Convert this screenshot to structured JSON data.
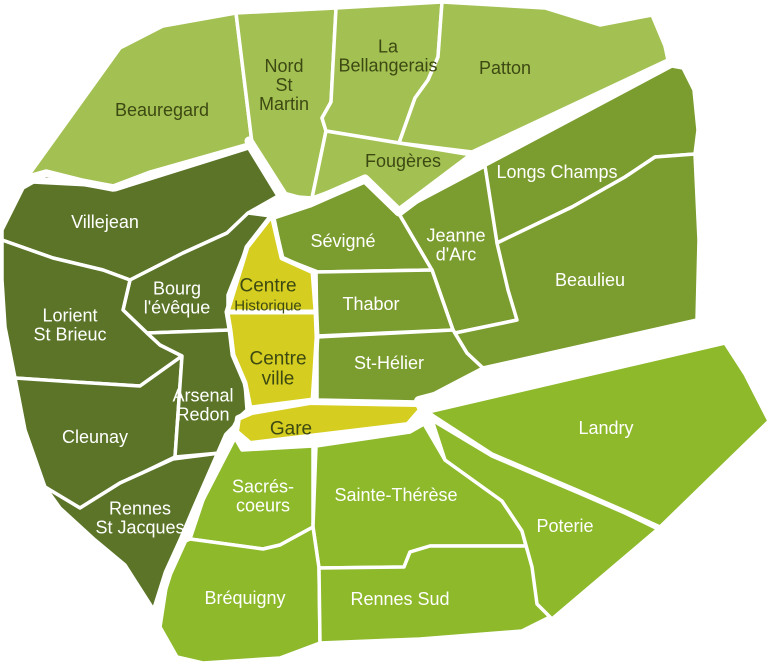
{
  "map": {
    "title": "Quartiers de Rennes",
    "background": "#ffffff",
    "width": 784,
    "height": 667
  },
  "colors": {
    "outer_north": "#a3c052",
    "inner_west": "#5b7428",
    "inner_east": "#7b9c2e",
    "outer_south": "#8db92a",
    "centre": "#d5cd1f",
    "border": "#ffffff",
    "label_dark": "#3d4912",
    "label_light": "#ffffff"
  },
  "districts": [
    {
      "id": "beauregard",
      "name": "Beauregard",
      "lines": [
        "Beauregard"
      ],
      "zone": "outer_north",
      "label": {
        "x": 162,
        "y": 110,
        "color": "dark",
        "size": 18
      },
      "points": "28,176 120,48 163,26 236,13 252,143 150,172 113,186 82,180 46,171"
    },
    {
      "id": "nord-st-martin",
      "name": "Nord St Martin",
      "lines": [
        "Nord",
        "St",
        "Martin"
      ],
      "zone": "outer_north",
      "label": {
        "x": 284,
        "y": 85,
        "color": "dark",
        "size": 18
      },
      "points": "236,13 336,8 331,102 322,118 326,131 312,198 283,196 252,143"
    },
    {
      "id": "la-bellangerais",
      "name": "La Bellangerais",
      "lines": [
        "La",
        "Bellangerais"
      ],
      "zone": "outer_north",
      "label": {
        "x": 388,
        "y": 56,
        "color": "dark",
        "size": 18
      },
      "points": "336,8 442,2 438,57 428,80 415,98 399,143 326,131 322,118 331,102"
    },
    {
      "id": "patton",
      "name": "Patton",
      "lines": [
        "Patton"
      ],
      "zone": "outer_north",
      "label": {
        "x": 505,
        "y": 68,
        "color": "dark",
        "size": 18
      },
      "points": "442,2 545,8 600,25 652,15 665,46 668,60 472,152 399,143 415,98 428,80 438,57"
    },
    {
      "id": "fougeres",
      "name": "Fougères",
      "lines": [
        "Fougères"
      ],
      "zone": "outer_north",
      "label": {
        "x": 403,
        "y": 161,
        "color": "dark",
        "size": 18
      },
      "points": "326,131 399,143 472,155 399,212 365,179 312,198"
    },
    {
      "id": "longs-champs",
      "name": "Longs Champs",
      "lines": [
        "Longs Champs"
      ],
      "zone": "inner_east",
      "label": {
        "x": 557,
        "y": 172,
        "color": "light",
        "size": 18
      },
      "points": "480,168 672,66 683,68 694,90 698,130 695,154 655,157 625,177 572,207 497,243"
    },
    {
      "id": "villejean",
      "name": "Villejean",
      "lines": [
        "Villejean"
      ],
      "zone": "inner_west",
      "label": {
        "x": 105,
        "y": 222,
        "color": "light",
        "size": 18
      },
      "points": "23,188 46,175 82,184 113,190 150,176 248,147 278,196 248,213 227,233 183,253 130,280 103,270 53,258 2,240 2,230"
    },
    {
      "id": "bourg-leveque",
      "name": "Bourg l'évêque",
      "lines": [
        "Bourg",
        "l'évêque"
      ],
      "zone": "inner_west",
      "label": {
        "x": 177,
        "y": 298,
        "color": "light",
        "size": 18
      },
      "points": "130,280 183,253 227,233 248,213 271,216 247,247 228,295 228,312 230,330 147,333 123,310"
    },
    {
      "id": "lorient-st-brieuc",
      "name": "Lorient St Brieuc",
      "lines": [
        "Lorient",
        "St Brieuc"
      ],
      "zone": "inner_west",
      "label": {
        "x": 70,
        "y": 325,
        "color": "light",
        "size": 18
      },
      "points": "2,240 53,258 103,270 130,280 123,310 147,333 160,345 182,356 140,386 75,382 15,378 5,327 2,280"
    },
    {
      "id": "cleunay",
      "name": "Cleunay",
      "lines": [
        "Cleunay"
      ],
      "zone": "inner_west",
      "label": {
        "x": 95,
        "y": 437,
        "color": "light",
        "size": 18
      },
      "points": "15,378 75,382 140,386 182,356 175,457 140,474 120,483 80,508 45,487 25,430"
    },
    {
      "id": "arsenal-redon",
      "name": "Arsenal Redon",
      "lines": [
        "Arsenal",
        "Redon"
      ],
      "zone": "inner_west",
      "label": {
        "x": 203,
        "y": 405,
        "color": "light",
        "size": 18
      },
      "points": "147,333 230,330 233,355 245,383 247,410 238,418 220,453 175,457 182,356 160,345"
    },
    {
      "id": "rennes-st-jacques",
      "name": "Rennes St Jacques",
      "lines": [
        "Rennes",
        "St Jacques"
      ],
      "zone": "inner_west",
      "label": {
        "x": 140,
        "y": 518,
        "color": "light",
        "size": 18
      },
      "points": "45,487 80,508 120,483 173,459 220,453 197,507 183,540 168,573 155,612 125,565 95,540 60,508"
    },
    {
      "id": "sevigne",
      "name": "Sévigné",
      "lines": [
        "Sévigné"
      ],
      "zone": "inner_east",
      "label": {
        "x": 343,
        "y": 241,
        "color": "light",
        "size": 18
      },
      "points": "274,218 310,206 365,181 398,212 432,270 318,272 282,258"
    },
    {
      "id": "jeanne-darc",
      "name": "Jeanne d'Arc",
      "lines": [
        "Jeanne",
        "d'Arc"
      ],
      "zone": "inner_east",
      "label": {
        "x": 456,
        "y": 245,
        "color": "light",
        "size": 18
      },
      "points": "398,212 485,166 497,243 517,320 503,323 455,333 453,330 432,270"
    },
    {
      "id": "thabor",
      "name": "Thabor",
      "lines": [
        "Thabor"
      ],
      "zone": "inner_east",
      "label": {
        "x": 371,
        "y": 304,
        "color": "light",
        "size": 18
      },
      "points": "316,272 432,270 453,330 317,336"
    },
    {
      "id": "st-helier",
      "name": "St-Hélier",
      "lines": [
        "St-Hélier"
      ],
      "zone": "inner_east",
      "label": {
        "x": 389,
        "y": 363,
        "color": "light",
        "size": 18
      },
      "points": "317,337 453,330 467,353 483,368 418,402 317,400"
    },
    {
      "id": "beaulieu",
      "name": "Beaulieu",
      "lines": [
        "Beaulieu"
      ],
      "zone": "inner_east",
      "label": {
        "x": 590,
        "y": 280,
        "color": "light",
        "size": 18
      },
      "points": "497,243 572,207 625,177 655,157 695,154 699,240 697,320 483,368 467,353 455,333 503,323 517,320 508,290"
    },
    {
      "id": "centre-historique",
      "name": "Centre Historique",
      "lines": [
        "Centre",
        "Historique"
      ],
      "zone": "centre",
      "label": {
        "x": 268,
        "y": 296,
        "color": "dark",
        "size": 19,
        "line_sizes": [
          19,
          15
        ]
      },
      "points": "272,215 282,258 313,272 316,312 227,312 247,247"
    },
    {
      "id": "centre-ville",
      "name": "Centre ville",
      "lines": [
        "Centre",
        "ville"
      ],
      "zone": "centre",
      "label": {
        "x": 278,
        "y": 369,
        "color": "dark",
        "size": 19
      },
      "points": "227,312 316,312 317,337 315,370 313,400 250,408 245,383 233,355 230,330"
    },
    {
      "id": "sacres-coeurs",
      "name": "Sacrés-coeurs",
      "lines": [
        "Sacrés-",
        "coeurs"
      ],
      "zone": "outer_south",
      "label": {
        "x": 263,
        "y": 496,
        "color": "light",
        "size": 18
      },
      "points": "242,450 313,446 313,527 280,545 263,549 190,539 203,500 235,438"
    },
    {
      "id": "sainte-therese",
      "name": "Sainte-Thérèse",
      "lines": [
        "Sainte-Thérèse"
      ],
      "zone": "outer_south",
      "label": {
        "x": 396,
        "y": 495,
        "color": "light",
        "size": 18
      },
      "points": "316,446 410,432 424,424 445,460 502,501 522,531 526,546 430,546 410,552 404,567 319,568 313,527"
    },
    {
      "id": "brequigny",
      "name": "Bréquigny",
      "lines": [
        "Bréquigny"
      ],
      "zone": "outer_south",
      "label": {
        "x": 245,
        "y": 598,
        "color": "light",
        "size": 18
      },
      "points": "190,539 263,549 280,545 313,527 319,568 320,643 280,658 203,663 177,657 160,627 168,575 183,542"
    },
    {
      "id": "rennes-sud",
      "name": "Rennes Sud",
      "lines": [
        "Rennes Sud"
      ],
      "zone": "outer_south",
      "label": {
        "x": 400,
        "y": 599,
        "color": "light",
        "size": 18
      },
      "points": "319,568 404,567 410,552 430,546 526,546 550,617 522,631 420,639 320,643"
    },
    {
      "id": "landry",
      "name": "Landry",
      "lines": [
        "Landry"
      ],
      "zone": "outer_south",
      "label": {
        "x": 606,
        "y": 428,
        "color": "light",
        "size": 18
      },
      "points": "428,412 725,343 745,374 769,421 660,527 625,511 579,491 492,454 435,417"
    },
    {
      "id": "poterie",
      "name": "Poterie",
      "lines": [
        "Poterie"
      ],
      "zone": "outer_south",
      "label": {
        "x": 565,
        "y": 526,
        "color": "light",
        "size": 18
      },
      "points": "432,420 492,456 579,493 625,513 658,529 552,619 537,604 532,567 522,531 502,501 445,460"
    },
    {
      "id": "gare",
      "name": "Gare",
      "lines": [
        "Gare"
      ],
      "zone": "centre",
      "label": {
        "x": 291,
        "y": 429,
        "color": "dark",
        "size": 19
      },
      "points": "238,418 252,412 310,402 418,404 421,410 408,425 300,438 250,444 236,432"
    }
  ],
  "thick_borders": [
    {
      "id": "beauregard-villejean",
      "points": "28,180 85,183 115,188 150,177 249,146",
      "width": 7
    },
    {
      "id": "north-diagonal",
      "points": "249,141 284,196 310,203 365,179 399,212 472,157 670,63",
      "width": 9
    },
    {
      "id": "southwest-diagonal",
      "points": "238,426 228,436 197,507 183,540 168,573 156,611",
      "width": 9
    },
    {
      "id": "southeast-diagonal",
      "points": "419,401 560,364 698,326",
      "width": 10
    }
  ]
}
